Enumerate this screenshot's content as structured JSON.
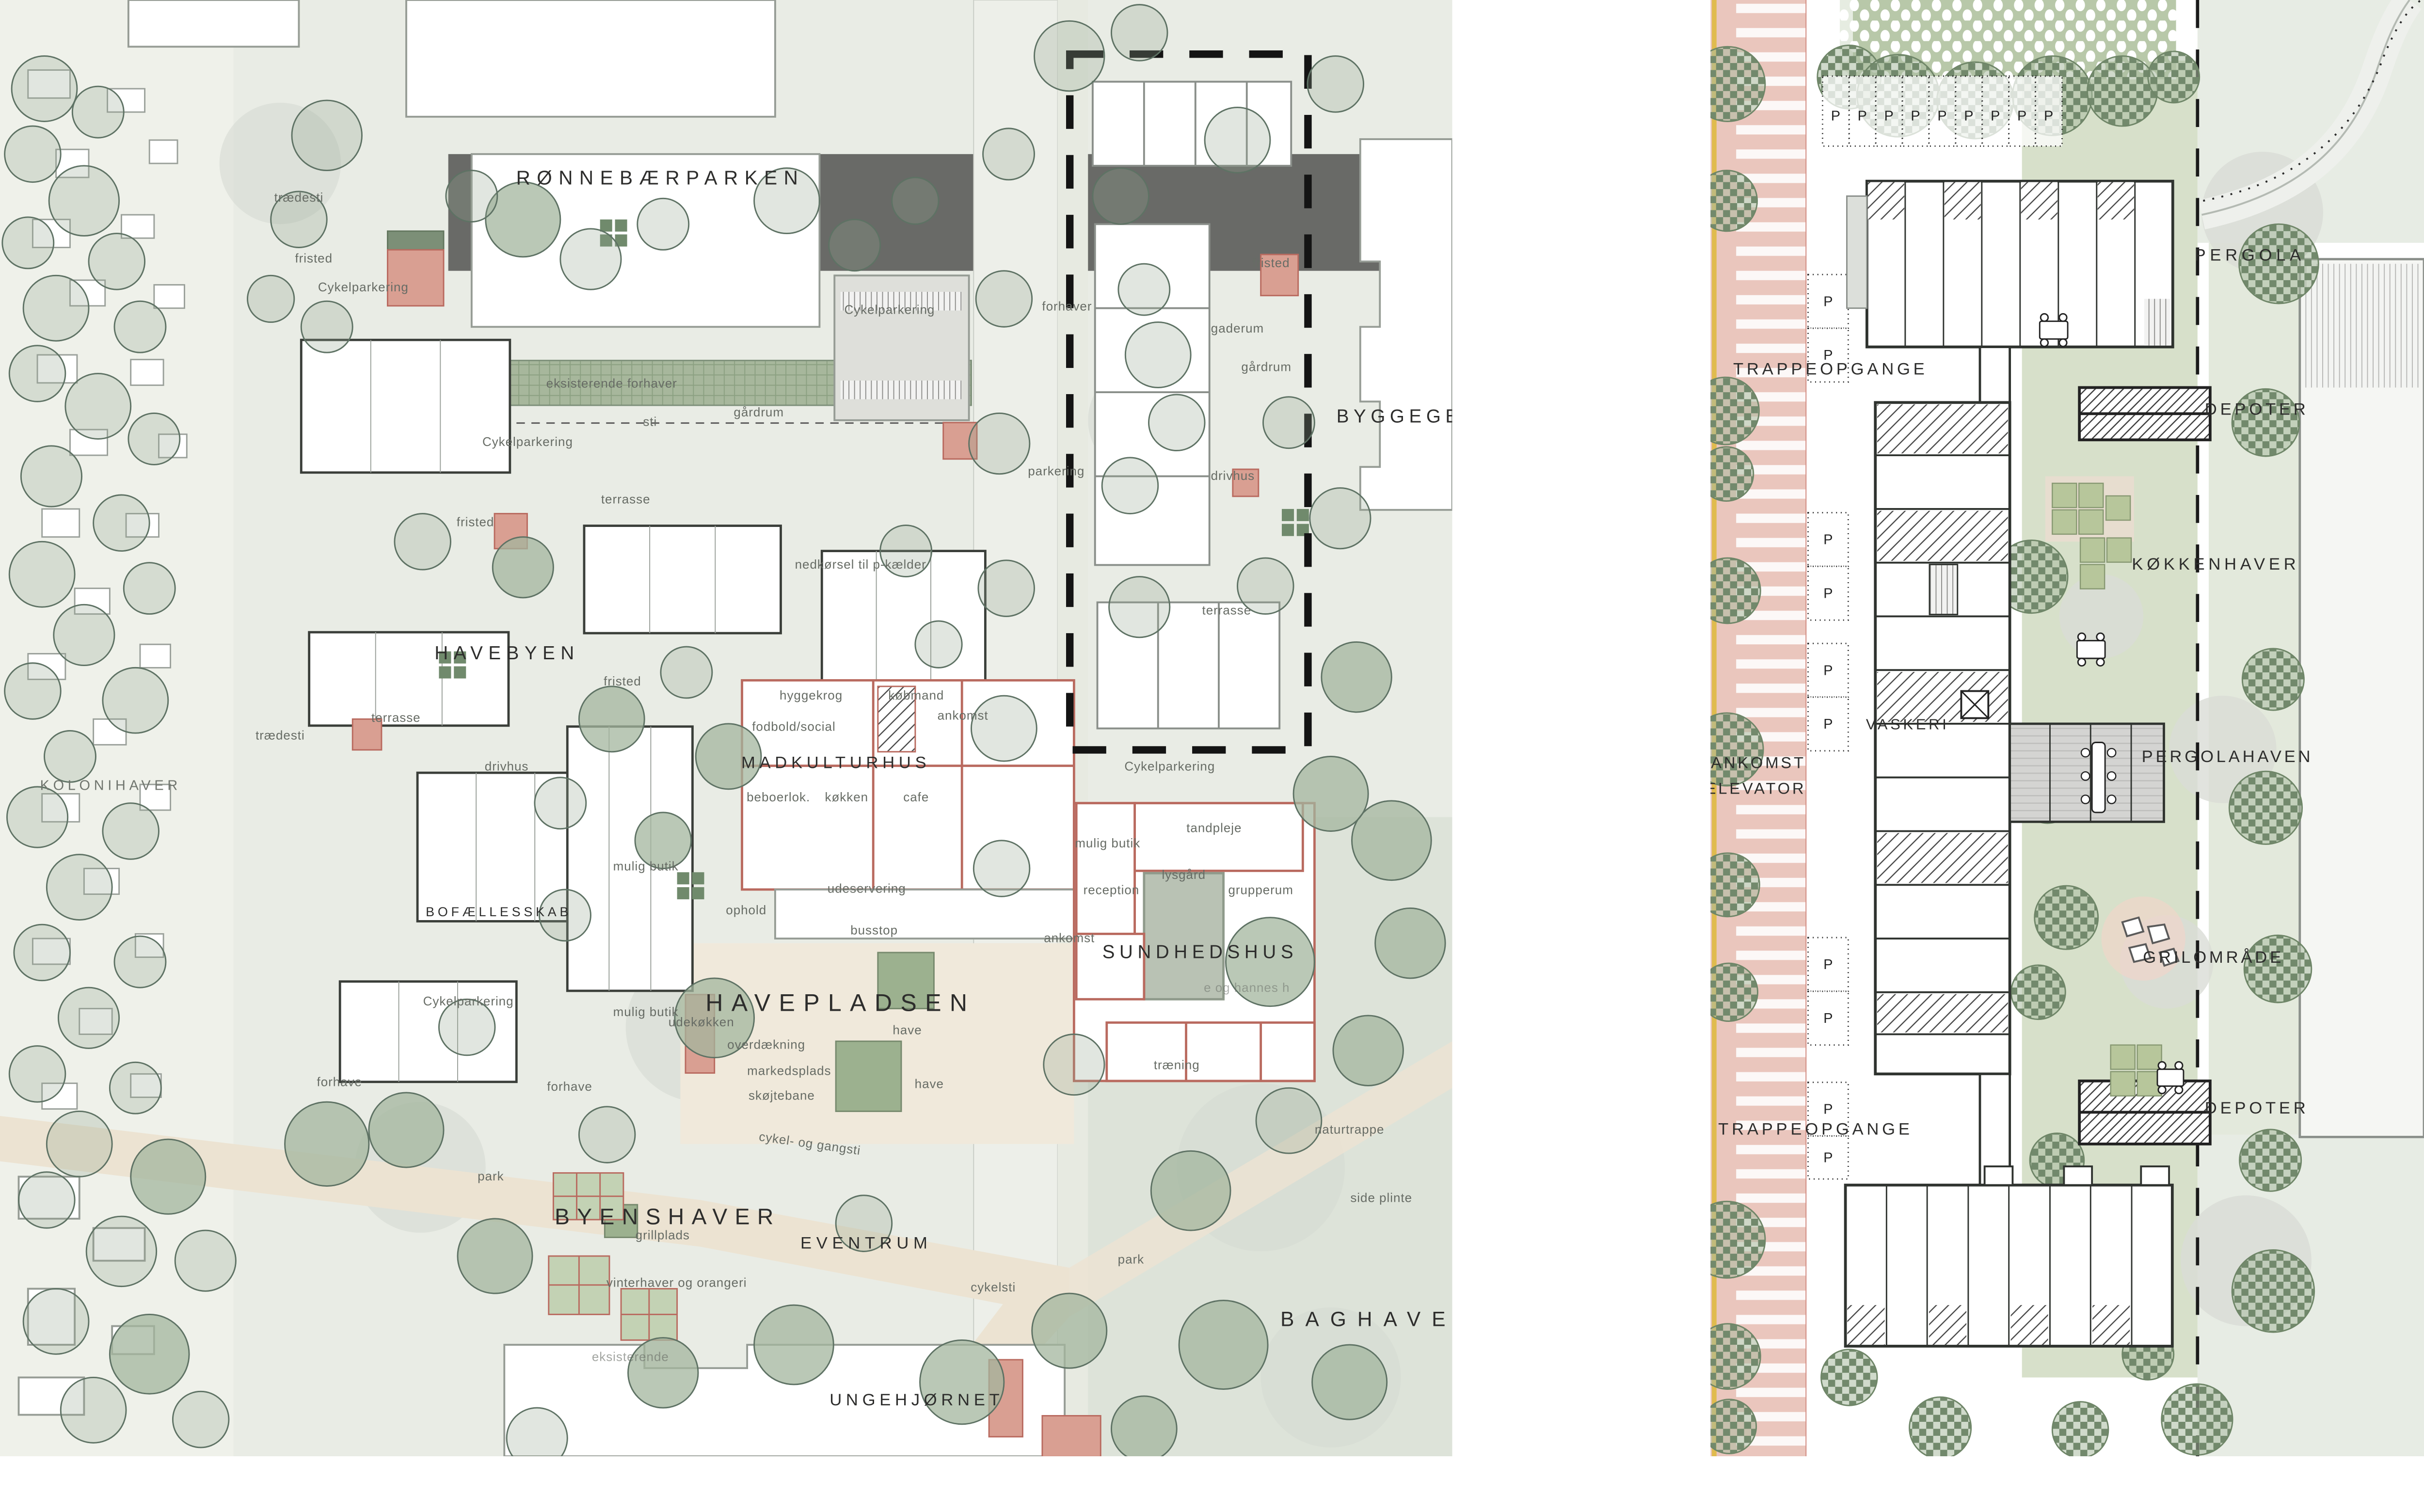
{
  "document": {
    "type": "site-plan",
    "panels": [
      "masterplan",
      "building-plan"
    ]
  },
  "palette": {
    "paper": "#ffffff",
    "land": "#e9ece5",
    "lawn": "#d7e0ca",
    "road_beige": "#ece3d2",
    "plaza": "#f0e9db",
    "tree_green": "#5e7264",
    "building_outline": "#3a3e39",
    "existing_outline": "#969c95",
    "accent_red": "#b96a5f",
    "accent_red_fill": "#d99f92",
    "boundary_dash": "#141414",
    "road_pink": "#eac6bd",
    "road_yellow_line": "#e0bb4e",
    "checker_green": "#72896c"
  },
  "left_panel": {
    "labels": {
      "ronnebaerparken": "RØNNEBÆRPARKEN",
      "havebyen": "HAVEBYEN",
      "kolonihaver": "KOLONIHAVER",
      "bofaellesskab": "BOFÆLLESSKAB",
      "madkulturhus": "MADKULTURHUS",
      "havepladsen": "HAVEPLADSEN",
      "sundhedshus": "SUNDHEDSHUS",
      "byenshaver": "BYENSHAVER",
      "eventrum": "EVENTRUM",
      "ungehjornet": "UNGEHJØRNET",
      "baghave": "BAGHAVE",
      "byggege": "BYGGEGE",
      "traedesti1": "trædesti",
      "traedesti2": "trædesti",
      "fristed1": "fristed",
      "fristed2": "fristed",
      "fristed3": "fristed",
      "fristed4": "fristed",
      "cykelparkering1": "Cykelparkering",
      "cykelparkering2": "Cykelparkering",
      "cykelparkering3": "Cykelparkering",
      "cykelparkering4": "Cykelparkering",
      "cykelparkering5": "Cykelparkering",
      "gaderum": "gaderum",
      "forhaver": "forhaver",
      "eksisterende_forhaver": "eksisterende forhaver",
      "sti": "sti",
      "gaardrum1": "gårdrum",
      "gaardrum2": "gårdrum",
      "parkering": "parkering",
      "drivhus1": "drivhus",
      "drivhus2": "drivhus",
      "nedkoersel": "nedkørsel til p-kælder",
      "terrasse1": "terrasse",
      "terrasse2": "terrasse",
      "terrasse3": "terrasse",
      "hyggekrog": "hyggekrog",
      "kobmand": "købmand",
      "ankomst1": "ankomst",
      "ankomst2": "ankomst",
      "fodbold_social": "fodbold/social",
      "beboerlok": "beboerlok.",
      "kokken": "køkken",
      "cafe": "cafe",
      "mulig_butik1": "mulig butik",
      "mulig_butik2": "mulig butik",
      "mulig_butik3": "mulig butik",
      "tandpleje": "tandpleje",
      "reception": "reception",
      "lysgaard": "lysgård",
      "grupperum": "grupperum",
      "traening": "træning",
      "udeservering": "udeservering",
      "ophold": "ophold",
      "busstop": "busstop",
      "udekokken": "udekøkken",
      "overdaekning": "overdækning",
      "markedsplads": "markedsplads",
      "skojtebane": "skøjtebane",
      "have1": "have",
      "have2": "have",
      "forhave1": "forhave",
      "forhave2": "forhave",
      "cykel_og_gangsti": "cykel- og gangsti",
      "naturtrappe": "naturtrappe",
      "park1": "park",
      "park2": "park",
      "grillplads": "grillplads",
      "side_plinte": "side plinte",
      "vinterhaver": "vinterhaver og orangeri",
      "cykelsti": "cykelsti",
      "hannes": "e og hannes h",
      "eksisterende": "eksisterende"
    }
  },
  "right_panel": {
    "labels": {
      "pergola": "PERGOLA",
      "trappeopgange_top": "TRAPPEOPGANGE",
      "depoter_top": "DEPOTER",
      "kokkenhaver": "KØKKENHAVER",
      "vaskeri": "VASKERI",
      "pergolahaven": "PERGOLAHAVEN",
      "ankomst": "ANKOMST",
      "elevator": "ELEVATOR",
      "grilomraade": "GRILOMRÅDE",
      "depoter_bottom": "DEPOTER",
      "trappeopgange_bottom": "TRAPPEOPGANGE"
    },
    "parking_marker": "P",
    "parking_stalls_top_count": 9,
    "parking_stalls_side_count": 10
  }
}
